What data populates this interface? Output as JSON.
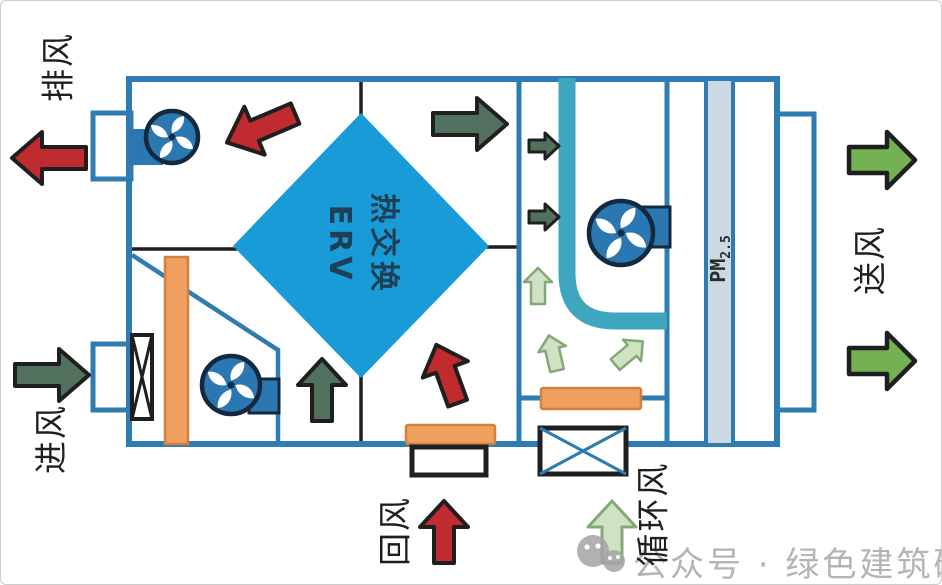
{
  "diagram": {
    "description": "ERV energy-recovery ventilation unit airflow diagram",
    "labels": {
      "exhaust": "排风",
      "intake": "进风",
      "return_air": "回风",
      "circulation_air": "循环风",
      "supply": "送风"
    },
    "erv_core": {
      "line_zh": "热交换",
      "line_en": "ERV"
    },
    "pm_filter": {
      "prefix": "PM",
      "subscript": "2.5"
    }
  },
  "watermark": {
    "text": "公众号 · 绿色建筑研习社"
  },
  "colors": {
    "unit_blue": "#2e7cb1",
    "line_black": "#1f1f1f",
    "core_blue": "#189bd7",
    "fan_blue": "#2a77b2",
    "fan_outline": "#14293e",
    "pipe_teal": "#3fa6bf",
    "filter_orange": "#efa05e",
    "filter_orange_border": "#d2803b",
    "pm_gray": "#ccd8e2",
    "arrow_red": "#bf2b2f",
    "arrow_dark_green": "#51705d",
    "arrow_light_green": "#cfe2c2",
    "arrow_light_green_border": "#85a878",
    "arrow_supply_green": "#74b153",
    "watermark_gray": "#b4b4b4",
    "frame_border": "#cccccc"
  }
}
